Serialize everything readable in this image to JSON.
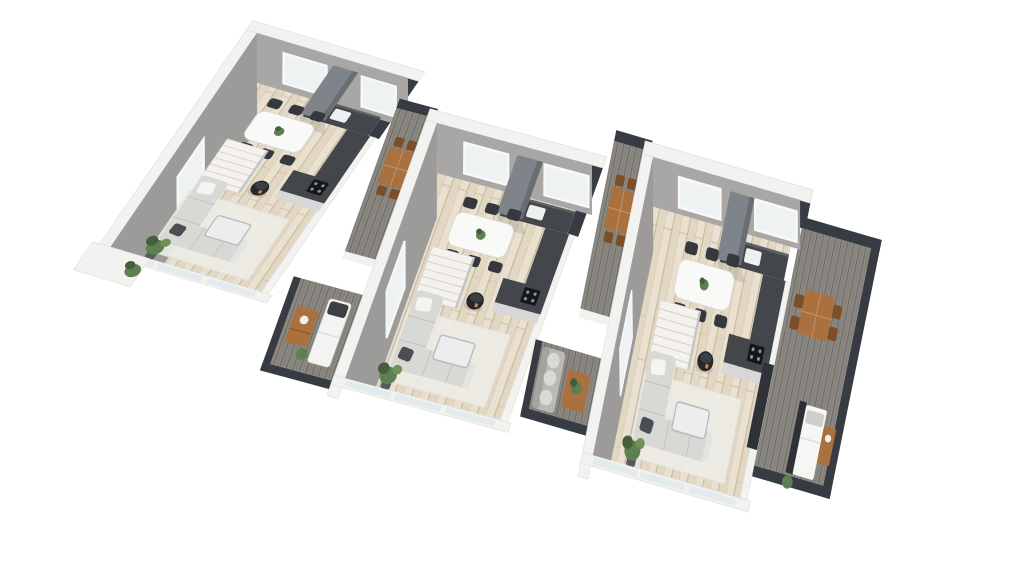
{
  "scene": {
    "title": "3D isometric floor plan - three staggered terraced house units",
    "view": "axonometric top-down",
    "background": "#ffffff"
  },
  "colors": {
    "background": "#ffffff",
    "wall_outer": "#f2f2f1",
    "wall_edge": "#e2e2e0",
    "wall_face": "#a9a7a5",
    "wall_face_side": "#9d9b99",
    "window_frame": "#f8f8f7",
    "window_glass": "#eef2f3",
    "floor": "#e9e0cf",
    "rug": "#edece6",
    "bottom_glass": "#e3eaed",
    "kitchen": "#43474c",
    "kitchen_front": "#d6d7d6",
    "column": "#7f848a",
    "dining_table": "#f9f9f8",
    "chair": "#35393e",
    "sofa": "#d8d8d5",
    "sofa_seam": "#c4c4c0",
    "coffee_table": "#eceeee",
    "stove": "#24272b",
    "stairs": "#f3f2ef",
    "deck": "#8b8781",
    "parapet": "#373c43",
    "outdoor_wood": "#aa713e",
    "outdoor_wood_dark": "#7d4f28",
    "plant": "#5d7f52",
    "plant_dark": "#455f3c",
    "lounger": "#f3f3f1",
    "outdoor_sofa": "#b9b9b5",
    "cushion": "#d9d9d6",
    "bed": "#f6f6f4",
    "bed_head": "#2e3136",
    "glass_panel": "#2f3338",
    "sink": "#eef0f0",
    "cooktop": "#15171a"
  },
  "units": [
    {
      "id": "unit-1",
      "position": "left",
      "rooms": [
        "open-plan living / dining / kitchen"
      ],
      "furniture": [
        "corner sofa",
        "coffee table",
        "rug",
        "dining table with six chairs",
        "kitchen counter with sink and cooktop",
        "chimney column",
        "wood stove",
        "staircase",
        "potted plants",
        "glazed balustrade front wall"
      ]
    },
    {
      "id": "unit-2",
      "position": "middle",
      "rooms": [
        "open-plan living / dining / kitchen",
        "entrance deck",
        "lower terrace"
      ],
      "furniture": [
        "corner sofa",
        "coffee table",
        "rug",
        "dining table with six chairs",
        "kitchen counter with sink and cooktop",
        "chimney column",
        "wood stove",
        "staircase",
        "outdoor dining table with chairs",
        "sun lounger",
        "wooden desk",
        "potted plants"
      ]
    },
    {
      "id": "unit-3",
      "position": "right",
      "rooms": [
        "open-plan living / dining / kitchen",
        "entrance deck",
        "lower terrace",
        "side roof terrace"
      ],
      "furniture": [
        "corner sofa",
        "coffee table",
        "rug",
        "dining table with six chairs",
        "kitchen counter with sink and cooktop",
        "chimney column",
        "wood stove",
        "staircase",
        "outdoor sofa with cushions",
        "wooden coffee table",
        "outdoor dining table with four chairs",
        "daybed with dark headboard",
        "wooden dresser",
        "potted plants",
        "dark glass panel"
      ]
    }
  ]
}
